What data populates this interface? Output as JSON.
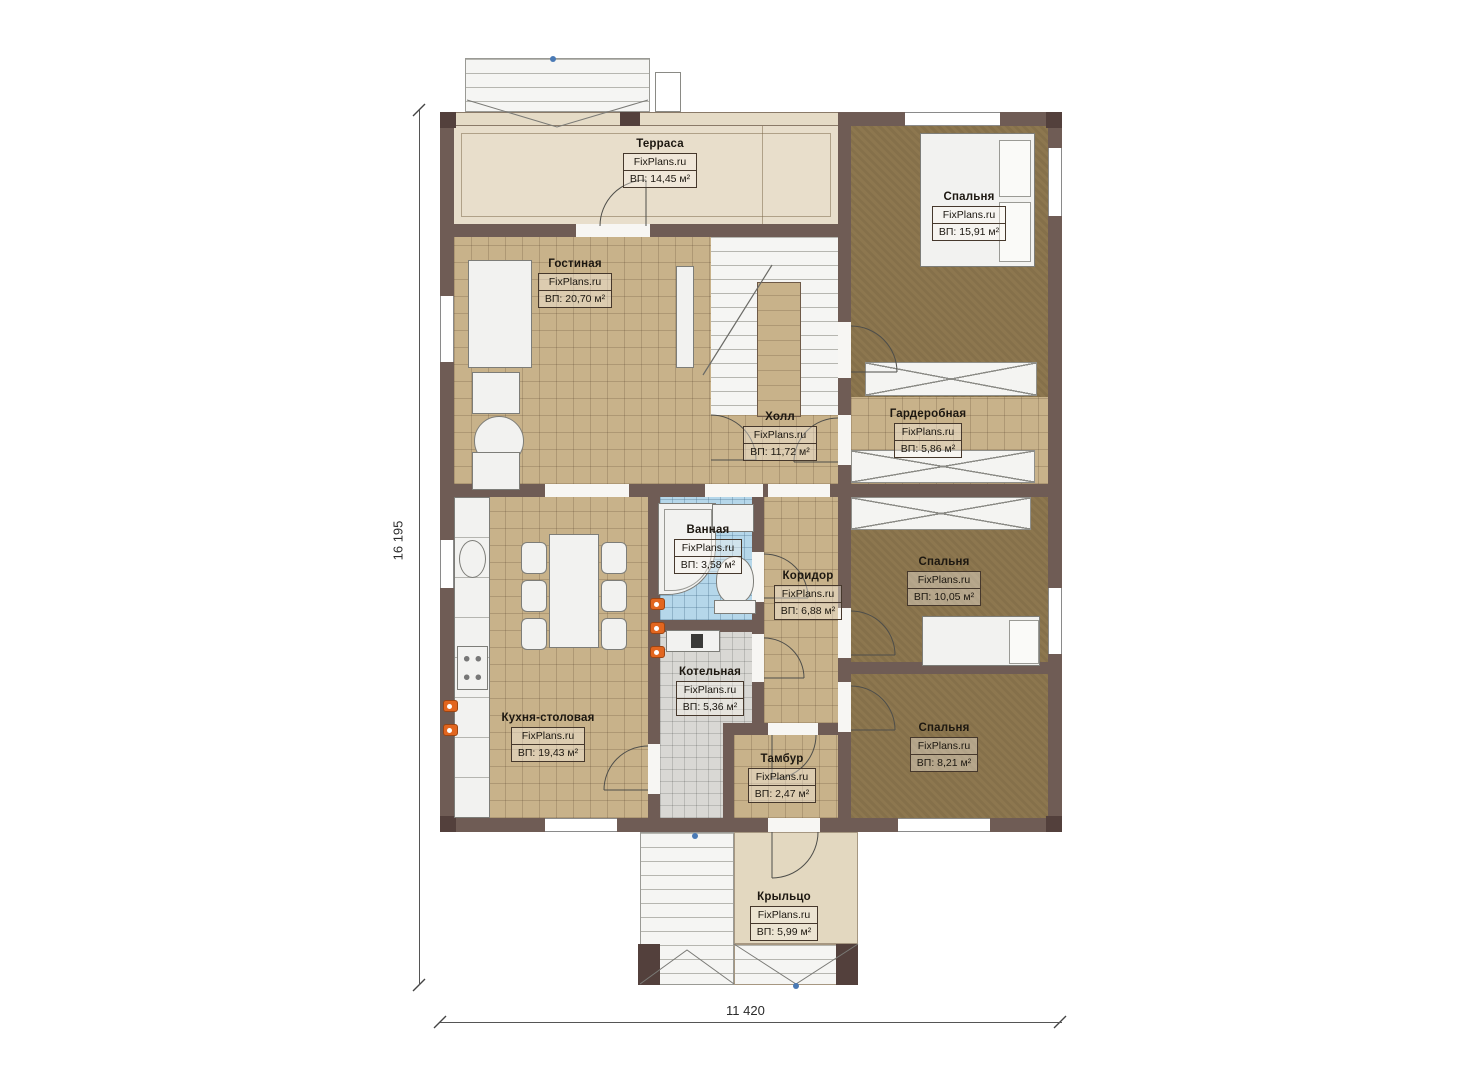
{
  "brand": "FixPlans.ru",
  "rooms": [
    {
      "name": "Терраса",
      "area": "ВП: 14,45 м²"
    },
    {
      "name": "Спальня",
      "area": "ВП: 15,91 м²"
    },
    {
      "name": "Гостиная",
      "area": "ВП: 20,70 м²"
    },
    {
      "name": "Холл",
      "area": "ВП: 11,72 м²"
    },
    {
      "name": "Гардеробная",
      "area": "ВП: 5,86 м²"
    },
    {
      "name": "Ванная",
      "area": "ВП: 3,58 м²"
    },
    {
      "name": "Коридор",
      "area": "ВП: 6,88 м²"
    },
    {
      "name": "Спальня",
      "area": "ВП: 10,05 м²"
    },
    {
      "name": "Кухня-столовая",
      "area": "ВП: 19,43 м²"
    },
    {
      "name": "Котельная",
      "area": "ВП: 5,36 м²"
    },
    {
      "name": "Тамбур",
      "area": "ВП: 2,47 м²"
    },
    {
      "name": "Спальня",
      "area": "ВП: 8,21 м²"
    },
    {
      "name": "Крыльцо",
      "area": "ВП: 5,99 м²"
    }
  ],
  "dimensions": {
    "vertical": "16 195",
    "horizontal": "11 420"
  },
  "colors": {
    "wall": "#6f5c55",
    "wall_dark": "#53403c",
    "floor_tile": "#c8b28a",
    "floor_carpet": "#8d774f",
    "floor_terrace": "#e8decb",
    "floor_bath": "#b5d7ea",
    "floor_boiler": "#d9d8d4",
    "floor_porch": "#e3d8c0",
    "radiator": "#e2661f",
    "dim_line": "#555555"
  }
}
